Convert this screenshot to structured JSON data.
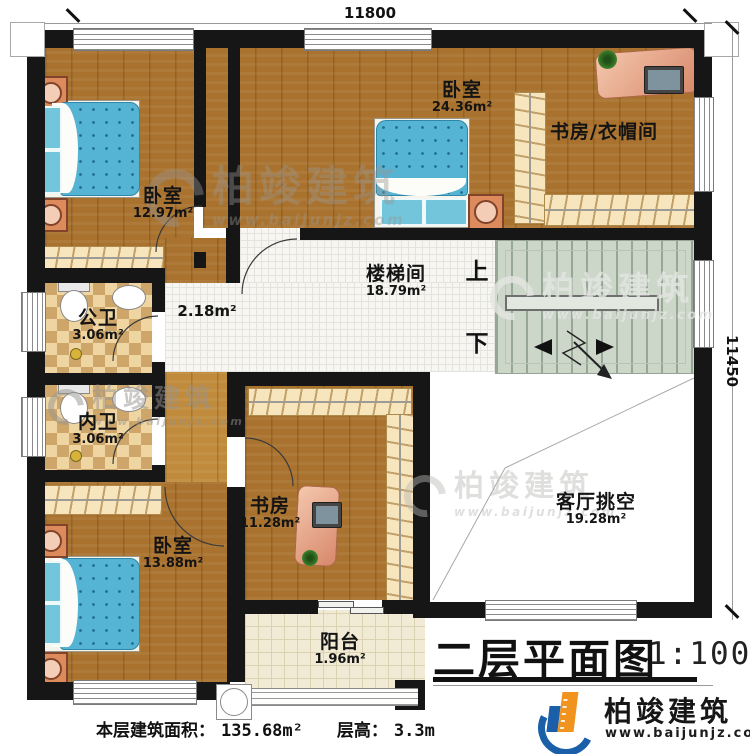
{
  "dimensions": {
    "top": "11800",
    "right": "11450"
  },
  "rooms": {
    "bedroom_nw": {
      "name": "卧室",
      "area": "12.97m²"
    },
    "bedroom_n": {
      "name": "卧室",
      "area": "24.36m²"
    },
    "study_cloak": {
      "name": "书房/衣帽间"
    },
    "stairwell": {
      "name": "楼梯间",
      "area": "18.79m²"
    },
    "corridor": {
      "area": "2.18m²"
    },
    "public_bath": {
      "name": "公卫",
      "area": "3.06m²"
    },
    "inner_bath": {
      "name": "内卫",
      "area": "3.06m²"
    },
    "bedroom_sw": {
      "name": "卧室",
      "area": "13.88m²"
    },
    "study": {
      "name": "书房",
      "area": "11.28m²"
    },
    "balcony": {
      "name": "阳台",
      "area": "1.96m²"
    },
    "living_void": {
      "name": "客厅挑空",
      "area": "19.28m²"
    }
  },
  "stairs": {
    "up": "上",
    "down": "下"
  },
  "title_block": {
    "title": "二层平面图",
    "scale": "1:100"
  },
  "notes": {
    "area_label": "本层建筑面积：",
    "area_value": "135.68m²",
    "floor_height_label": "层高：",
    "floor_height_value": "3.3m"
  },
  "brand": {
    "name": "柏竣建筑",
    "website": "www.baijunjz.com"
  },
  "watermark": {
    "name": "柏竣建筑",
    "website": "www.baijunjz.com"
  },
  "colors": {
    "wall": "#161616",
    "wood": "#a9722e",
    "wood_light": "#c08b3c",
    "tile_white": "#f7f6f2",
    "tile_check_a": "#eed5a2",
    "tile_check_b": "#cfa66a",
    "stairs": "#ccd6c9",
    "closet": "#f7e6bd",
    "bed": "#55b3d4",
    "desk": "#e8a58c",
    "brand_orange": "#f0941f",
    "brand_blue": "#1a5fa8"
  }
}
